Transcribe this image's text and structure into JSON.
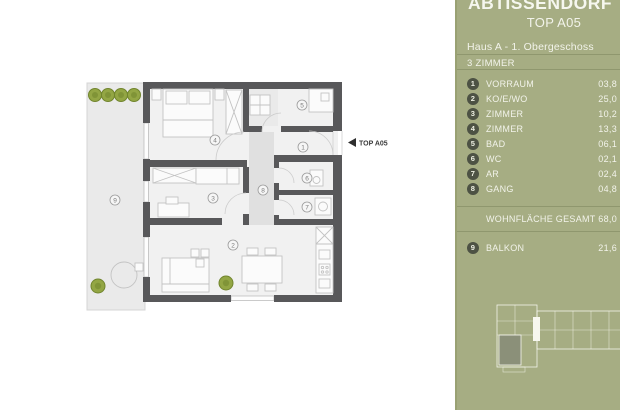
{
  "project": {
    "title": "ABTISSENDORF",
    "unit": "TOP A05"
  },
  "sidebar": {
    "building": "Haus A - 1. Obergeschoss",
    "type": "3 ZIMMER",
    "rooms": [
      {
        "num": "1",
        "label": "VORRAUM",
        "area": "03,8"
      },
      {
        "num": "2",
        "label": "KO/E/WO",
        "area": "25,0"
      },
      {
        "num": "3",
        "label": "ZIMMER",
        "area": "10,2"
      },
      {
        "num": "4",
        "label": "ZIMMER",
        "area": "13,3"
      },
      {
        "num": "5",
        "label": "BAD",
        "area": "06,1"
      },
      {
        "num": "6",
        "label": "WC",
        "area": "02,1"
      },
      {
        "num": "7",
        "label": "AR",
        "area": "02,4"
      },
      {
        "num": "8",
        "label": "GANG",
        "area": "04,8"
      }
    ],
    "total": {
      "label": "WOHNFLÄCHE GESAMT",
      "area": "68,0"
    },
    "outdoor": {
      "num": "9",
      "label": "BALKON",
      "area": "21,6"
    }
  },
  "floorplan": {
    "entry_marker": "TOP A05",
    "markers": [
      {
        "num": "1",
        "x": 303,
        "y": 147
      },
      {
        "num": "2",
        "x": 233,
        "y": 245
      },
      {
        "num": "3",
        "x": 213,
        "y": 198
      },
      {
        "num": "4",
        "x": 215,
        "y": 140
      },
      {
        "num": "5",
        "x": 302,
        "y": 105
      },
      {
        "num": "6",
        "x": 307,
        "y": 178
      },
      {
        "num": "7",
        "x": 307,
        "y": 207
      },
      {
        "num": "8",
        "x": 263,
        "y": 190
      },
      {
        "num": "9",
        "x": 115,
        "y": 200
      }
    ]
  },
  "colors": {
    "sidebar_bg": "#a6ad83",
    "badge": "#4d5244",
    "wall": "#58585a",
    "tree": "#93a644",
    "text": "#f2f3ea"
  }
}
